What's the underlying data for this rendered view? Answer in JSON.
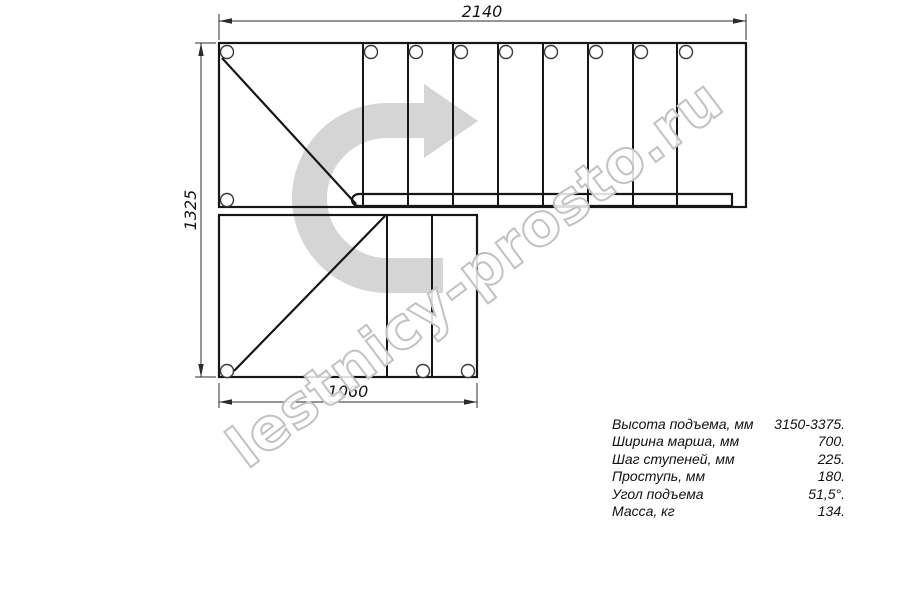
{
  "drawing": {
    "title": "staircase-plan-view",
    "watermark": "lestnicy-prosto.ru",
    "dimensions": {
      "top": "2140",
      "left": "1325",
      "bottom": "1060"
    }
  },
  "specs": {
    "rows": [
      {
        "label": "Высота подъема, мм",
        "value": "3150-3375."
      },
      {
        "label": "Ширина марша, мм",
        "value": "700."
      },
      {
        "label": "Шаг ступеней, мм",
        "value": "225."
      },
      {
        "label": "Проступь, мм",
        "value": "180."
      },
      {
        "label": "Угол подъема",
        "value": "51,5°."
      },
      {
        "label": "Масса, кг",
        "value": "134."
      }
    ]
  },
  "colors": {
    "outline": "#161616",
    "dim": "#2b2b2b",
    "dim_text": "#141414",
    "hole_stroke": "#3a3a3a",
    "arrow_gray": "#d5d5d5",
    "watermark_stroke": "#c2c2c2"
  }
}
